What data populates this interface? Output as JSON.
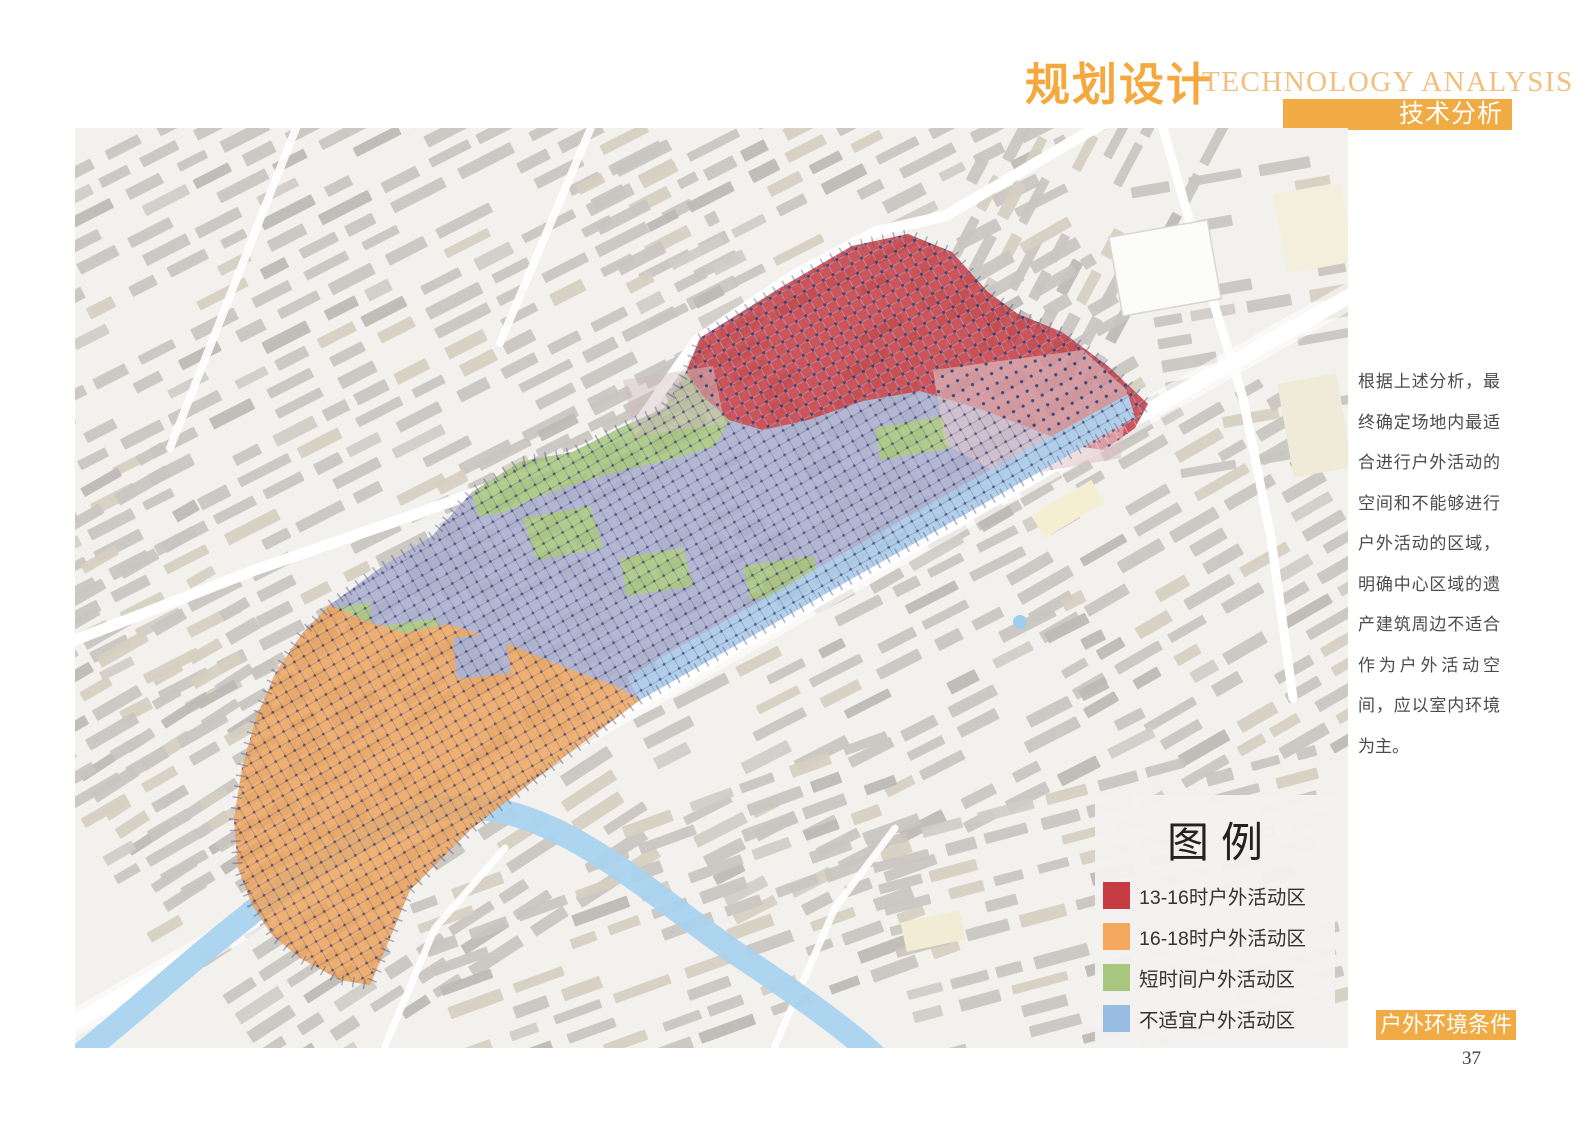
{
  "page": {
    "page_number": "37"
  },
  "header": {
    "title_cn": "规划设计",
    "title_en": "TECHNOLOGY ANALYSIS",
    "tab_label": "技术分析",
    "accent_color": "#f0ab45"
  },
  "annotation": {
    "paragraph": "根据上述分析，最终确定场地内最适合进行户外活动的空间和不能够进行户外活动的区域，明确中心区域的遗产建筑周边不适合作为户外活动空间，应以室内环境为主。"
  },
  "map": {
    "type": "site-analysis-map",
    "river_color": "#a9d3ef",
    "building_color": "#c9c6c0",
    "zone_colors": {
      "red": "#c53a41",
      "orange": "#eda55d",
      "green": "#a6c57c",
      "base": "#a9aecd",
      "strip": "#a6c8e8"
    }
  },
  "legend": {
    "title": "图例",
    "items": [
      {
        "label": "13-16时户外活动区",
        "color": "#c63c42"
      },
      {
        "label": "16-18时户外活动区",
        "color": "#f4a95f"
      },
      {
        "label": "短时间户外活动区",
        "color": "#a8c77e"
      },
      {
        "label": "不适宜户外活动区",
        "color": "#97bde2"
      }
    ]
  },
  "footer": {
    "tag_label": "户外环境条件",
    "accent_color": "#f0ab45"
  }
}
